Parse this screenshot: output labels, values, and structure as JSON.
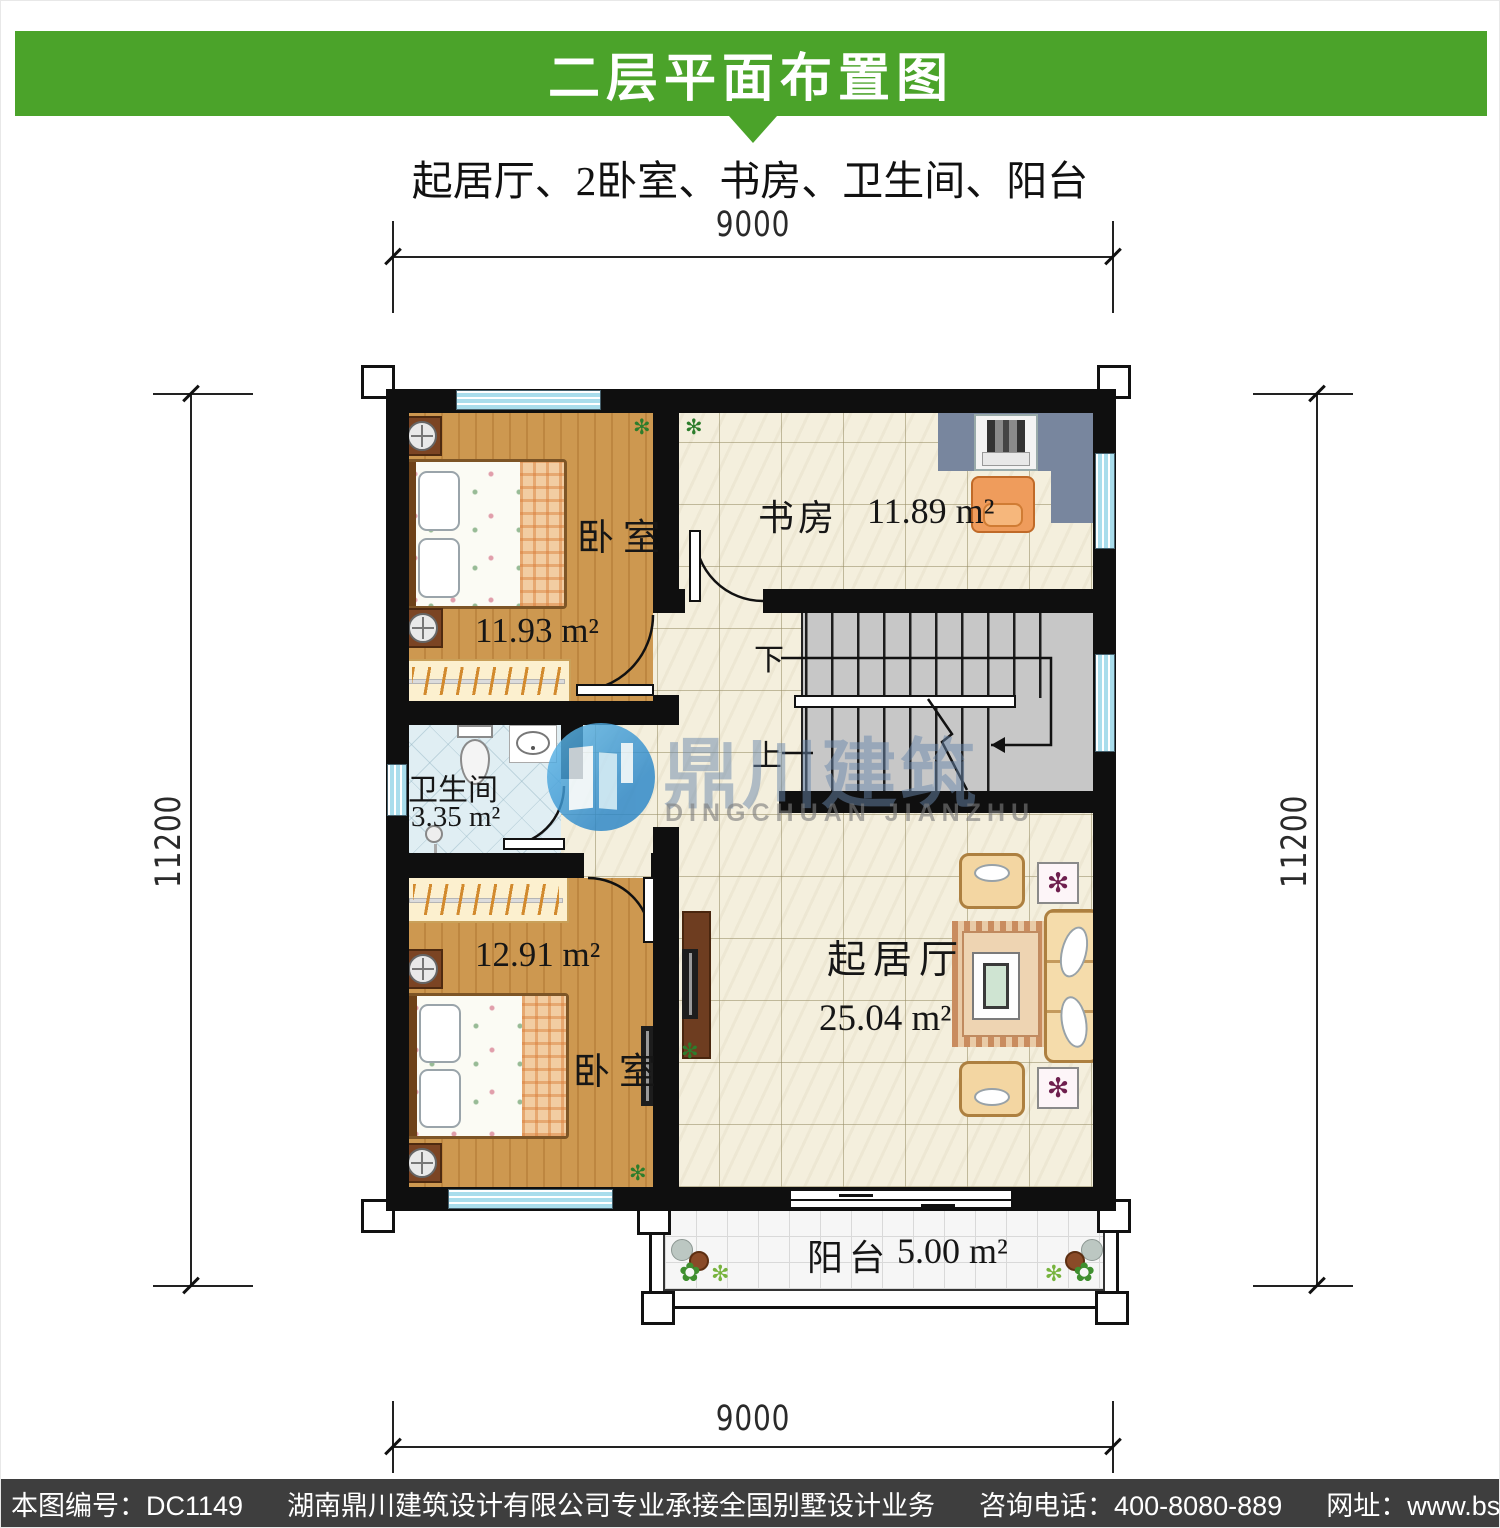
{
  "header": {
    "title": "二层平面布置图",
    "subtitle": "起居厅、2卧室、书房、卫生间、阳台"
  },
  "dimensions": {
    "top": "9000",
    "bottom": "9000",
    "left": "11200",
    "right": "11200"
  },
  "rooms": {
    "bedroom_top": {
      "name": "卧室",
      "area": "11.93 m²"
    },
    "study": {
      "name": "书房",
      "area": "11.89 m²"
    },
    "bathroom": {
      "name": "卫生间",
      "area": "3.35 m²"
    },
    "bedroom_bottom": {
      "name": "卧室",
      "area": "12.91 m²"
    },
    "living_room": {
      "name": "起居厅",
      "area": "25.04 m²"
    },
    "balcony": {
      "name": "阳台",
      "area": "5.00 m²"
    }
  },
  "stairs": {
    "down": "下",
    "up": "上"
  },
  "watermark": {
    "name_cn": "鼎川建筑",
    "name_en": "DINGCHUAN JIANZHU"
  },
  "footer": {
    "drawing_no": "本图编号：DC1149",
    "company": "湖南鼎川建筑设计有限公司专业承接全国别墅设计业务",
    "phone": "咨询电话：400-8080-889",
    "website": "网址：www.bstzcs.com"
  },
  "icons": {
    "plant": "✻",
    "blossom": "✿"
  },
  "colors": {
    "header_green": "#4ba32a",
    "footer_gray": "#3e3e3e",
    "wall": "#0f0f0f",
    "window_blue": "#a9ddec"
  }
}
